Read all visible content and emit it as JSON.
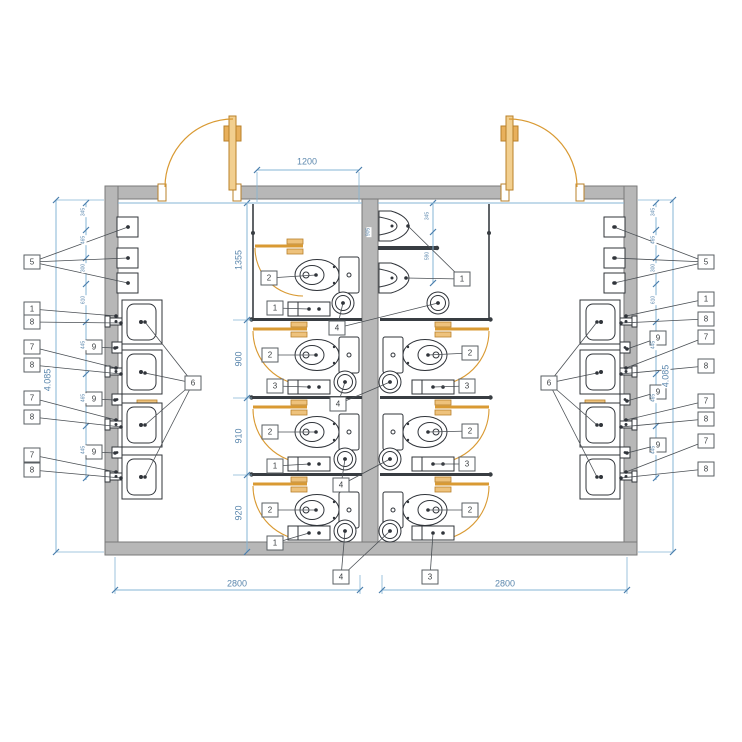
{
  "meta": {
    "drawing_type": "sanitary floor plan, mirrored male/female restrooms",
    "units": "mm"
  },
  "colors": {
    "wall_fill": "#b7b7b7",
    "wall_stroke": "#7a7a7a",
    "door_orange": "#d99a33",
    "door_fill": "#f2cf8f",
    "partition_dark": "#383d42",
    "fixture_stroke": "#30343a",
    "dim_line_blue": "#85b4d4",
    "dim_text_blue": "#5b87ad",
    "leader_gray": "#4a4f54"
  },
  "dims": {
    "top_width": "1200",
    "row_heights": [
      "1355",
      "900",
      "910",
      "920"
    ],
    "total_left": "4.085",
    "total_right": "4.085",
    "bottom_left": "2800",
    "bottom_right": "2800",
    "urinal_1": "345",
    "urinal_2": "590",
    "wall_len": "905",
    "wall_ticks_left": [
      "345",
      "465",
      "300",
      "610",
      "445",
      "465",
      "445"
    ],
    "wall_ticks_right": [
      "345",
      "465",
      "300",
      "610",
      "445",
      "465",
      "445"
    ]
  },
  "callouts": [
    {
      "label": "5",
      "x": 32,
      "y": 262,
      "targets": [
        [
          128,
          227
        ],
        [
          128,
          258
        ],
        [
          128,
          283
        ]
      ]
    },
    {
      "label": "1",
      "x": 32,
      "y": 309,
      "targets": [
        [
          116,
          316
        ]
      ]
    },
    {
      "label": "8",
      "x": 32,
      "y": 322,
      "targets": [
        [
          121,
          323
        ]
      ]
    },
    {
      "label": "7",
      "x": 32,
      "y": 347,
      "targets": [
        [
          116,
          368
        ]
      ]
    },
    {
      "label": "8",
      "x": 32,
      "y": 365,
      "targets": [
        [
          121,
          374
        ]
      ]
    },
    {
      "label": "7",
      "x": 32,
      "y": 398,
      "targets": [
        [
          116,
          420
        ]
      ]
    },
    {
      "label": "8",
      "x": 32,
      "y": 417,
      "targets": [
        [
          121,
          427
        ]
      ]
    },
    {
      "label": "7",
      "x": 32,
      "y": 455,
      "targets": [
        [
          116,
          472
        ]
      ]
    },
    {
      "label": "8",
      "x": 32,
      "y": 470,
      "targets": [
        [
          121,
          478
        ]
      ]
    },
    {
      "label": "9",
      "x": 94,
      "y": 347,
      "targets": [
        [
          115,
          348
        ]
      ]
    },
    {
      "label": "9",
      "x": 94,
      "y": 399,
      "targets": [
        [
          115,
          400
        ]
      ]
    },
    {
      "label": "9",
      "x": 94,
      "y": 452,
      "targets": [
        [
          115,
          453
        ]
      ]
    },
    {
      "label": "6",
      "x": 193,
      "y": 383,
      "targets": [
        [
          145,
          322
        ],
        [
          145,
          373
        ],
        [
          145,
          425
        ],
        [
          145,
          477
        ]
      ]
    },
    {
      "label": "2",
      "x": 269,
      "y": 278,
      "targets": [
        [
          316,
          275
        ]
      ]
    },
    {
      "label": "2",
      "x": 270,
      "y": 355,
      "targets": [
        [
          316,
          355
        ]
      ]
    },
    {
      "label": "2",
      "x": 270,
      "y": 432,
      "targets": [
        [
          316,
          432
        ]
      ]
    },
    {
      "label": "2",
      "x": 270,
      "y": 510,
      "targets": [
        [
          316,
          510
        ]
      ]
    },
    {
      "label": "1",
      "x": 275,
      "y": 308,
      "targets": [
        [
          309,
          309
        ]
      ]
    },
    {
      "label": "3",
      "x": 275,
      "y": 386,
      "targets": [
        [
          309,
          387
        ]
      ]
    },
    {
      "label": "1",
      "x": 275,
      "y": 466,
      "targets": [
        [
          309,
          464
        ]
      ]
    },
    {
      "label": "1",
      "x": 275,
      "y": 543,
      "targets": [
        [
          309,
          533
        ]
      ]
    },
    {
      "label": "4",
      "x": 337,
      "y": 328,
      "targets": [
        [
          343,
          303
        ],
        [
          438,
          303
        ]
      ]
    },
    {
      "label": "4",
      "x": 338,
      "y": 404,
      "targets": [
        [
          345,
          382
        ],
        [
          390,
          382
        ]
      ]
    },
    {
      "label": "4",
      "x": 341,
      "y": 485,
      "targets": [
        [
          345,
          459
        ],
        [
          390,
          459
        ]
      ]
    },
    {
      "label": "4",
      "x": 341,
      "y": 577,
      "targets": [
        [
          345,
          531
        ],
        [
          390,
          531
        ]
      ]
    },
    {
      "label": "1",
      "x": 462,
      "y": 279,
      "targets": [
        [
          408,
          226
        ],
        [
          406,
          278
        ]
      ]
    },
    {
      "label": "2",
      "x": 470,
      "y": 353,
      "targets": [
        [
          428,
          355
        ]
      ]
    },
    {
      "label": "2",
      "x": 470,
      "y": 431,
      "targets": [
        [
          428,
          432
        ]
      ]
    },
    {
      "label": "2",
      "x": 470,
      "y": 510,
      "targets": [
        [
          428,
          510
        ]
      ]
    },
    {
      "label": "3",
      "x": 467,
      "y": 386,
      "targets": [
        [
          433,
          387
        ]
      ]
    },
    {
      "label": "3",
      "x": 467,
      "y": 464,
      "targets": [
        [
          433,
          464
        ]
      ]
    },
    {
      "label": "3",
      "x": 430,
      "y": 577,
      "targets": [
        [
          433,
          533
        ]
      ]
    },
    {
      "label": "5",
      "x": 706,
      "y": 262,
      "targets": [
        [
          614,
          227
        ],
        [
          614,
          258
        ],
        [
          614,
          283
        ]
      ]
    },
    {
      "label": "1",
      "x": 706,
      "y": 299,
      "targets": [
        [
          626,
          316
        ]
      ]
    },
    {
      "label": "8",
      "x": 706,
      "y": 319,
      "targets": [
        [
          621,
          323
        ]
      ]
    },
    {
      "label": "7",
      "x": 706,
      "y": 337,
      "targets": [
        [
          626,
          368
        ]
      ]
    },
    {
      "label": "8",
      "x": 706,
      "y": 366,
      "targets": [
        [
          621,
          374
        ]
      ]
    },
    {
      "label": "7",
      "x": 706,
      "y": 401,
      "targets": [
        [
          626,
          420
        ]
      ]
    },
    {
      "label": "8",
      "x": 706,
      "y": 419,
      "targets": [
        [
          621,
          427
        ]
      ]
    },
    {
      "label": "7",
      "x": 706,
      "y": 441,
      "targets": [
        [
          626,
          472
        ]
      ]
    },
    {
      "label": "8",
      "x": 706,
      "y": 469,
      "targets": [
        [
          621,
          478
        ]
      ]
    },
    {
      "label": "9",
      "x": 658,
      "y": 338,
      "targets": [
        [
          627,
          349
        ]
      ]
    },
    {
      "label": "9",
      "x": 658,
      "y": 392,
      "targets": [
        [
          627,
          401
        ]
      ]
    },
    {
      "label": "9",
      "x": 658,
      "y": 445,
      "targets": [
        [
          627,
          453
        ]
      ]
    },
    {
      "label": "6",
      "x": 549,
      "y": 383,
      "targets": [
        [
          597,
          322
        ],
        [
          597,
          373
        ],
        [
          597,
          425
        ],
        [
          597,
          477
        ]
      ]
    }
  ]
}
